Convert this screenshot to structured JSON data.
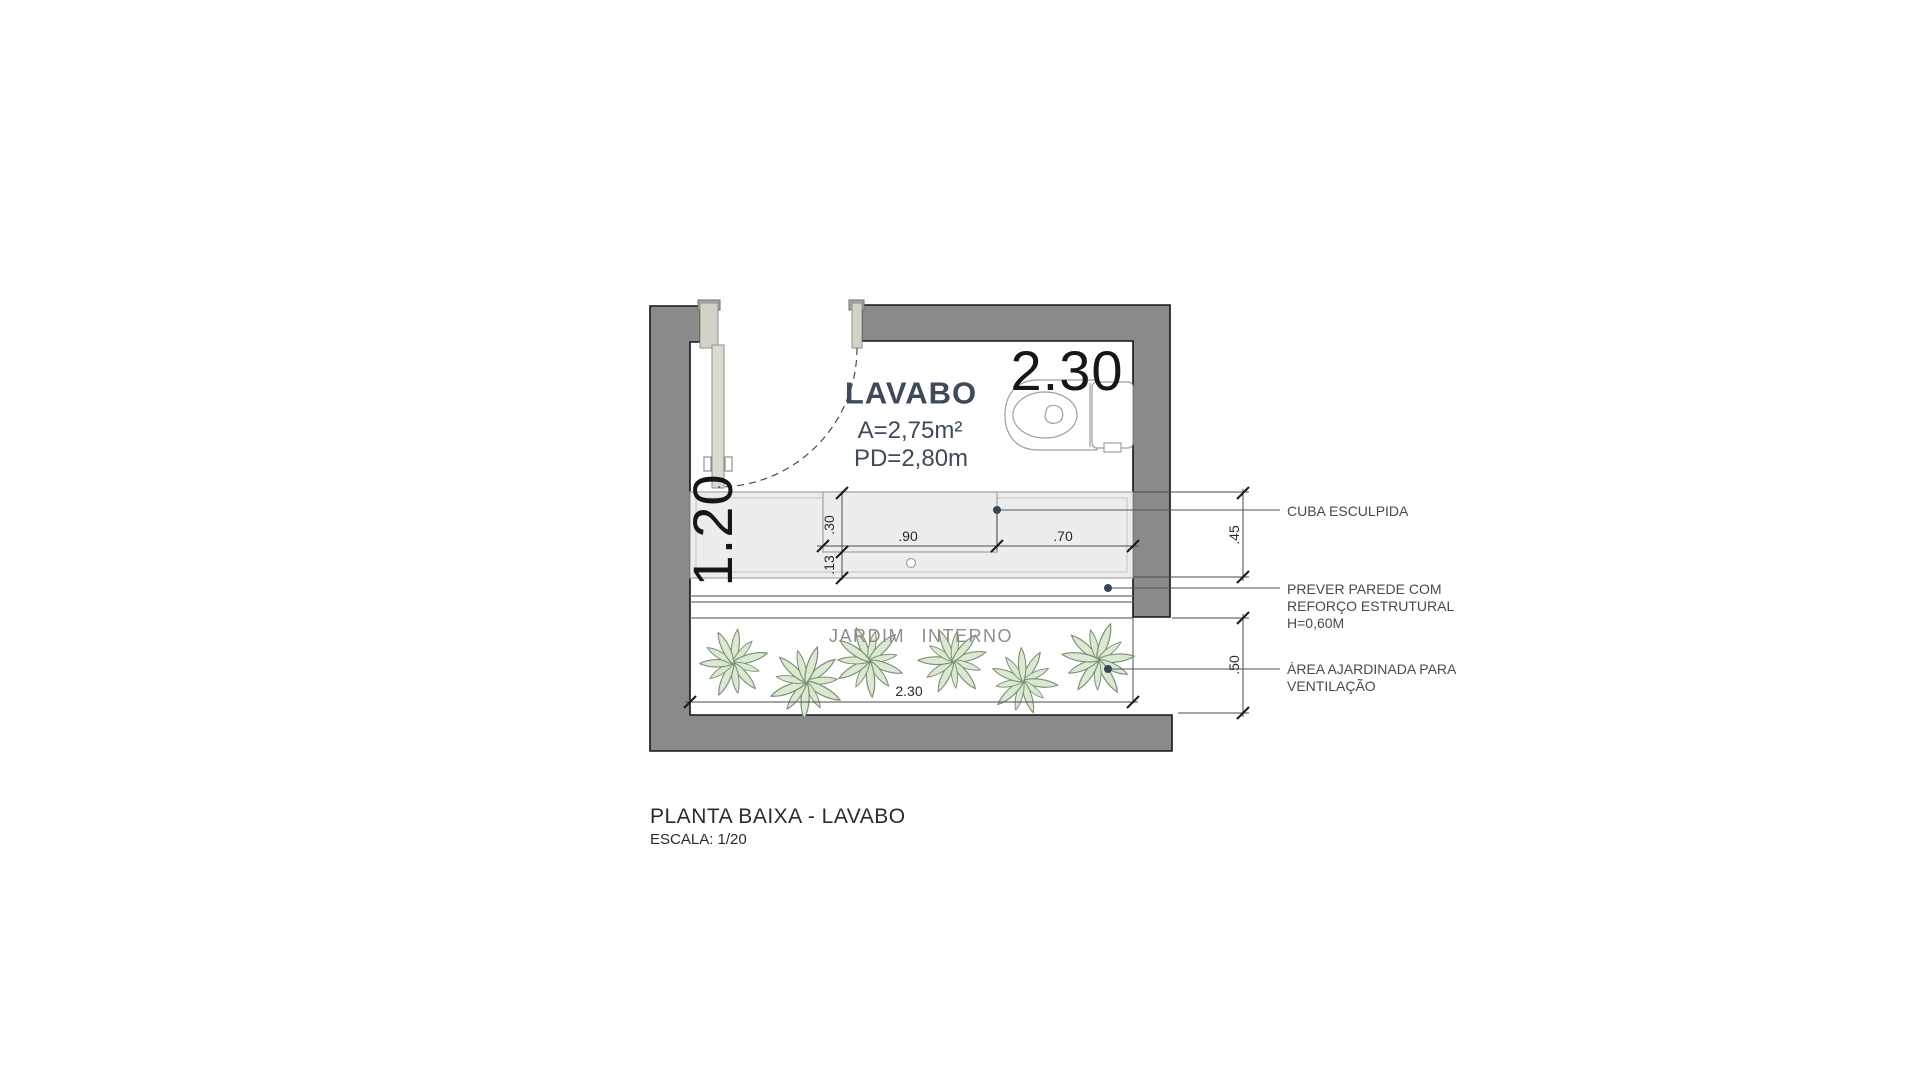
{
  "plan": {
    "room": {
      "name": "LAVABO",
      "area": "A=2,75m²",
      "ceiling": "PD=2,80m"
    },
    "overall": {
      "width": "2.30",
      "depth": "1.20"
    },
    "dims": {
      "basin_depth": ".30",
      "basin_width": ".90",
      "counter_side": ".70",
      "front_strip": ".13",
      "counter_depth": ".45",
      "garden_depth": ".50",
      "garden_width": "2.30"
    },
    "garden": {
      "label": "JARDIM INTERNO",
      "plant_count": "6"
    },
    "annotations": {
      "cuba": {
        "line1": "CUBA ESCULPIDA"
      },
      "parede": {
        "line1": "PREVER PAREDE COM",
        "line2": "REFORÇO ESTRUTURAL",
        "line3": "H=0,60M"
      },
      "jardim": {
        "line1": "ÁREA AJARDINADA PARA",
        "line2": "VENTILAÇÃO"
      }
    },
    "titleblock": {
      "title": "PLANTA BAIXA - LAVABO",
      "scale": "ESCALA: 1/20"
    },
    "colors": {
      "wall": "#8A8A8A",
      "door": "#DCD9CE",
      "counter_fill": "#EDEDED",
      "room_label": "#3E4A5C",
      "plant_fill": "#D9EAD0",
      "plant_stroke": "#7E8D77",
      "annotation_text": "#4A4A4A",
      "dimension_text": "#2A2A2A",
      "leader_dot": "#3A4654"
    }
  }
}
